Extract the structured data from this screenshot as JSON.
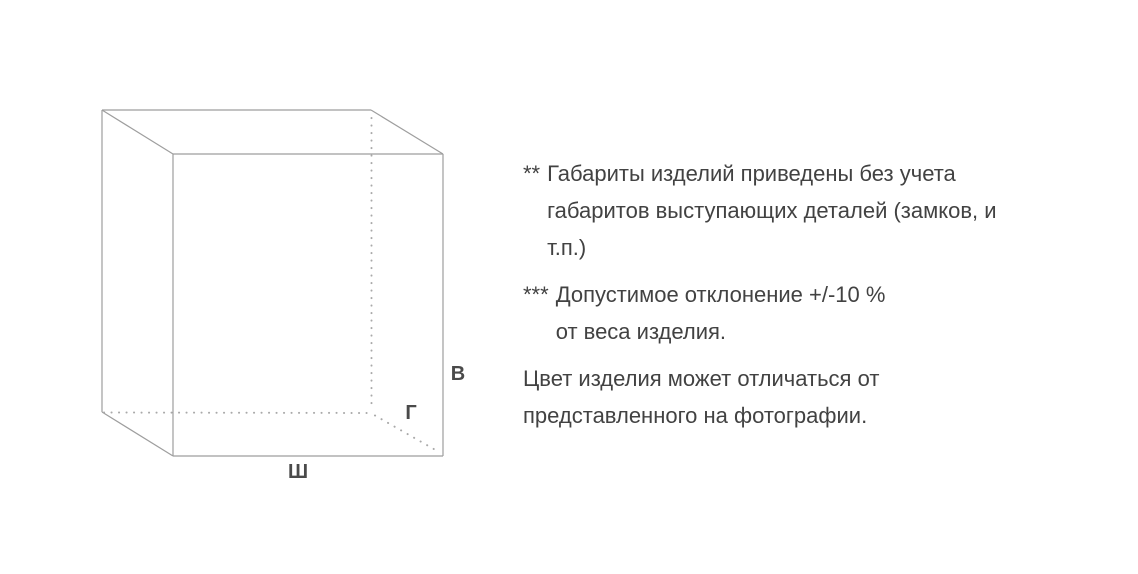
{
  "diagram": {
    "height_label": "В",
    "depth_label": "Г",
    "width_label": "Ш",
    "line_color": "#9e9e9e",
    "label_color": "#4a4a4a"
  },
  "notes": [
    {
      "marker": "**",
      "text": "Габариты изделий приведены без учета\nгабаритов выступающих деталей (замков, и\nт.п.)"
    },
    {
      "marker": "***",
      "text": "Допустимое отклонение +/-10 %\nот веса изделия."
    }
  ],
  "footer_note": "Цвет изделия может отличаться от\nпредставленного на фотографии.",
  "text_color": "#424242",
  "background_color": "#ffffff"
}
